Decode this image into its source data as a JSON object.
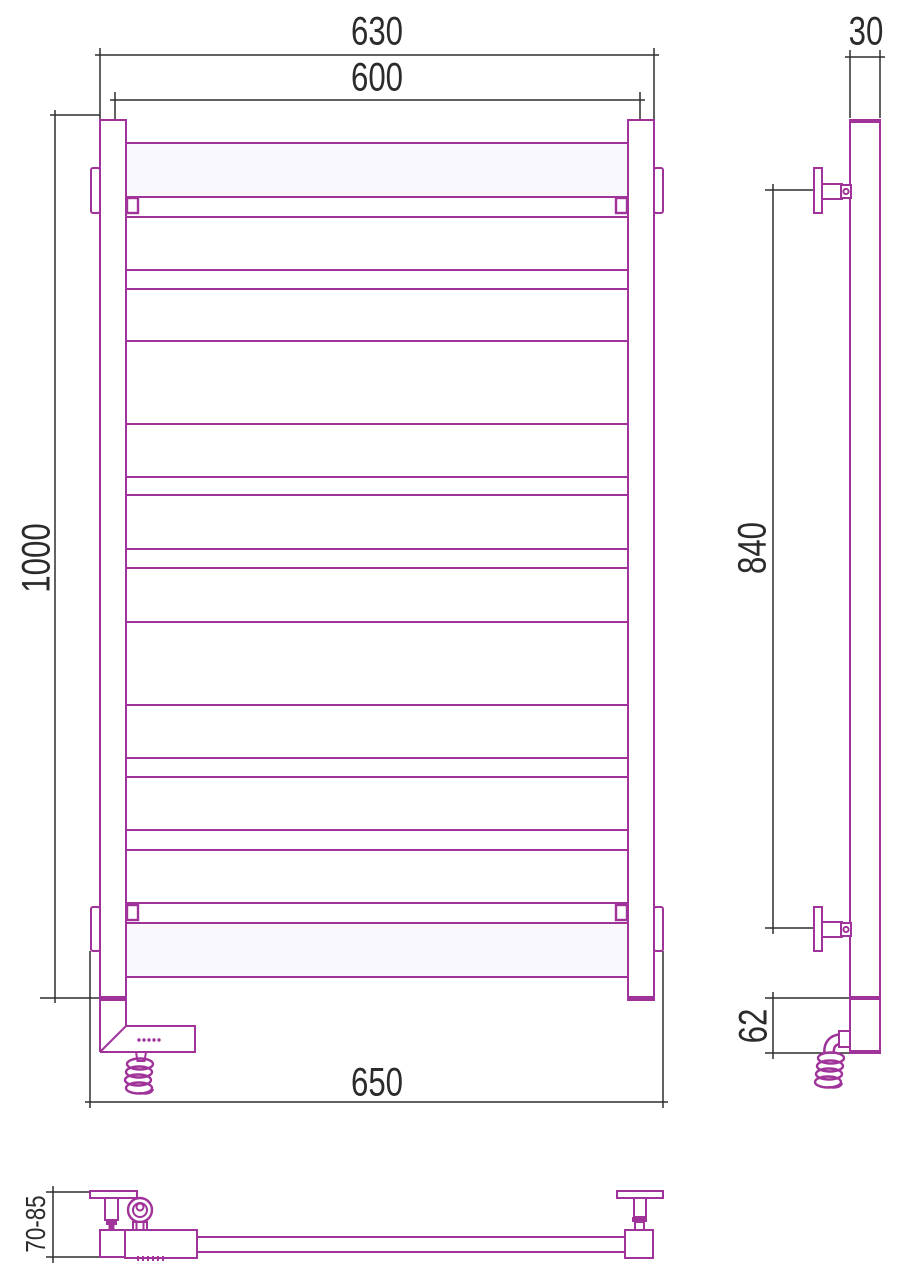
{
  "drawing": {
    "dimensions": {
      "overall_width_mm": "630",
      "rail_width_mm": "600",
      "overall_height_mm": "1000",
      "bracket_span_mm": "650",
      "profile_depth_mm": "30",
      "bracket_vertical_span_mm": "840",
      "heater_section_mm": "62",
      "wall_clearance_mm": "70-85"
    }
  },
  "colors": {
    "product_outline": "#a03399",
    "dimension_lines": "#2e2e2e",
    "dimension_text": "#2b2b2b",
    "rail_fill": "#f9f8fc",
    "background": "#ffffff"
  }
}
